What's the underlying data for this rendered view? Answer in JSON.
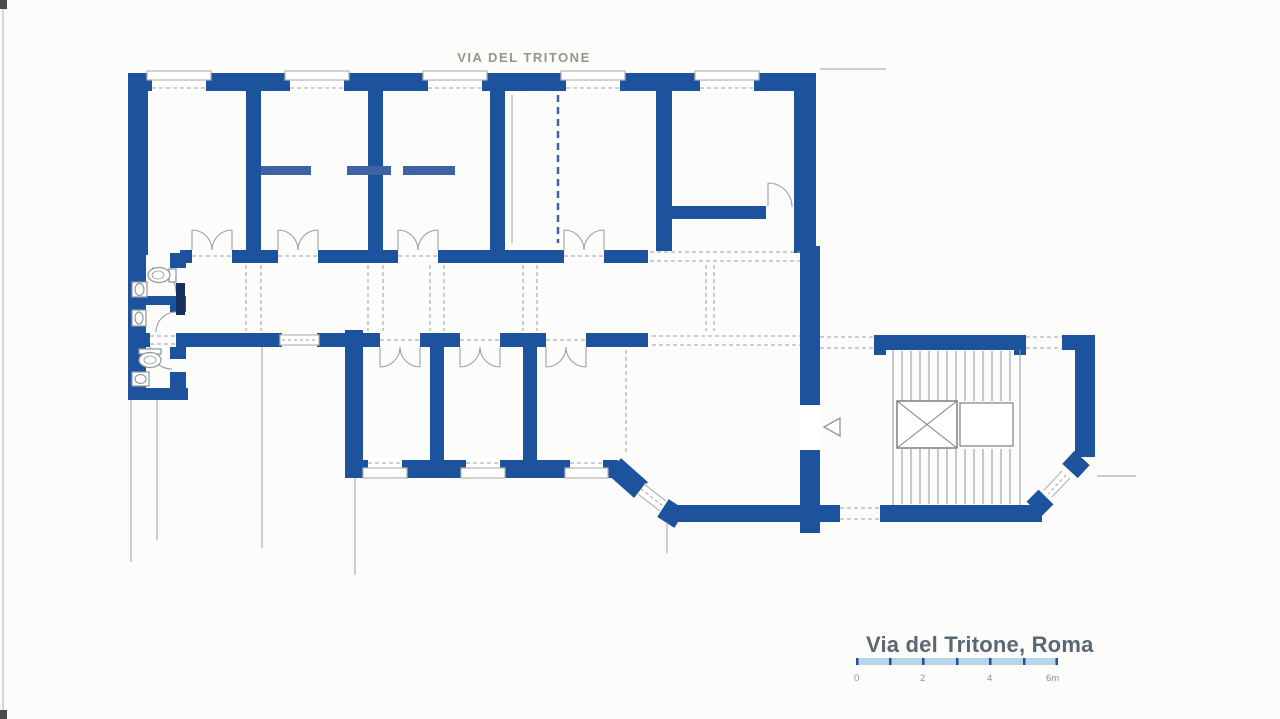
{
  "page": {
    "street_label": "VIA DEL TRITONE",
    "plan_title": "Via del Tritone, Roma"
  },
  "scale_bar": {
    "labels": [
      "0",
      "2",
      "4",
      "6m"
    ],
    "bar_color": "#b9d3e7",
    "tick_color": "#1d539c"
  },
  "colors": {
    "wall": "#1d539c",
    "wall_light": "#3e63a4",
    "detail_line": "#9aa0a4",
    "sill": "#b5b3ae",
    "street_text": "#97948c",
    "title_text": "#596872"
  }
}
